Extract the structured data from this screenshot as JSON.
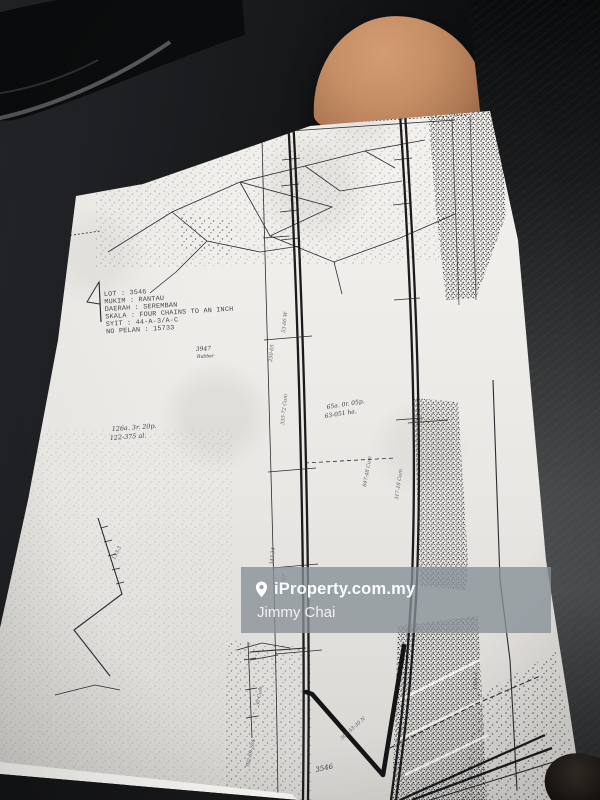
{
  "plan": {
    "header": {
      "lot": "LOT : 3546",
      "mukim": "MUKIM : RANTAU",
      "daerah": "DAERAH : SEREMBAN",
      "skala": "SKALA : FOUR CHAINS TO AN INCH",
      "syit": "SYIT : 44-A-3/A-C",
      "no_pelan": "NO PELAN : 15733"
    },
    "labels": {
      "lot_3947": "3947",
      "lot_3947_sub": "Rubber",
      "area_left_1": "126a. 3r. 20p.",
      "area_left_2": "122-375 al.",
      "area_center_1": "65a. 0r. 05p.",
      "area_center_2": "63-051 ha.",
      "lot_3546": "3546"
    },
    "annotations": [
      "335-72 Cum",
      "250-05",
      "847-48 Cum",
      "53-00 W",
      "343-34",
      "1000-0",
      "317-18 Cum",
      "50-057",
      "302-53-30 N",
      "30 Cum",
      "702-69-204",
      "133-3"
    ]
  },
  "watermark": {
    "brand": "iProperty.com.my",
    "agent": "Jimmy Chai",
    "pin_icon": "location-pin-icon",
    "band_color": "#8a9499",
    "text_color": "#ffffff"
  },
  "colors": {
    "paper": "#efede9",
    "ink": "#26262a",
    "car_interior": "#17181a",
    "skin": "#c68e65"
  }
}
